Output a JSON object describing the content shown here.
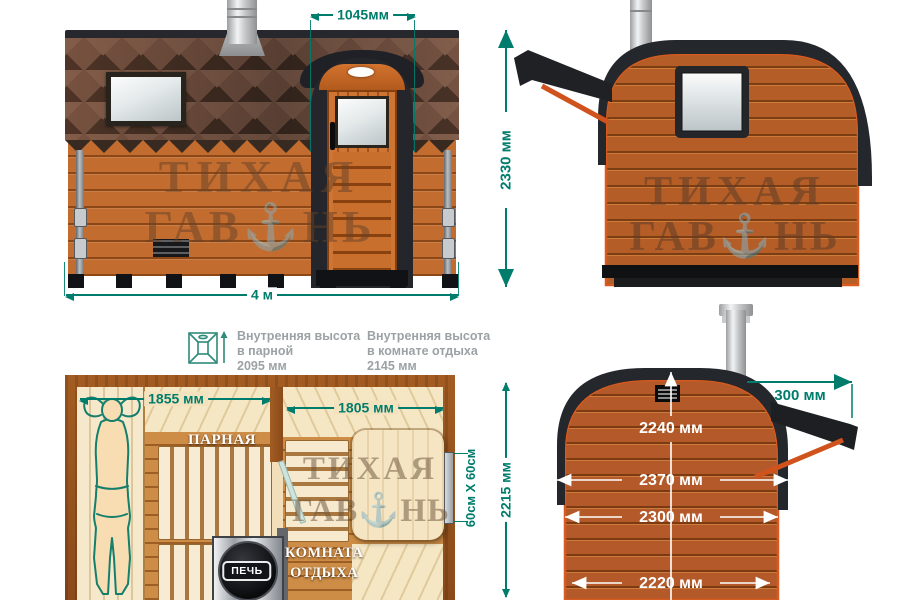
{
  "colors": {
    "dimension_green": "#007c6c",
    "white_dimension": "#ffffff",
    "wood_orange": "#b85e27",
    "dark_trim": "#24262b"
  },
  "watermark": {
    "line1": "ТИХАЯ",
    "line2": "ГАВ⚓НЬ"
  },
  "front": {
    "dim_door": "1045мм",
    "dim_width": "4 м"
  },
  "side": {
    "dim_height": "2330 мм"
  },
  "rear": {
    "dim_inner_height": "2240 мм",
    "dim_outer_width": "2370 мм",
    "dim_mid_width": "2300 мм",
    "dim_base_width": "2220 мм",
    "dim_awning": "300 мм"
  },
  "plan": {
    "dim_parnaya": "1855 мм",
    "dim_rest": "1805 мм",
    "dim_depth": "2215 мм",
    "dim_window": "60см X 60см",
    "room_parnaya": "ПАРНАЯ",
    "room_rest_1": "КОМНАТА",
    "room_rest_2": "ОТДЫХА",
    "stove": "ПЕЧЬ"
  },
  "notes": {
    "parnaya_1": "Внутренняя высота",
    "parnaya_2": "в парной",
    "parnaya_3": "2095 мм",
    "rest_1": "Внутренняя высота",
    "rest_2": "в комнате отдыха",
    "rest_3": "2145 мм"
  }
}
